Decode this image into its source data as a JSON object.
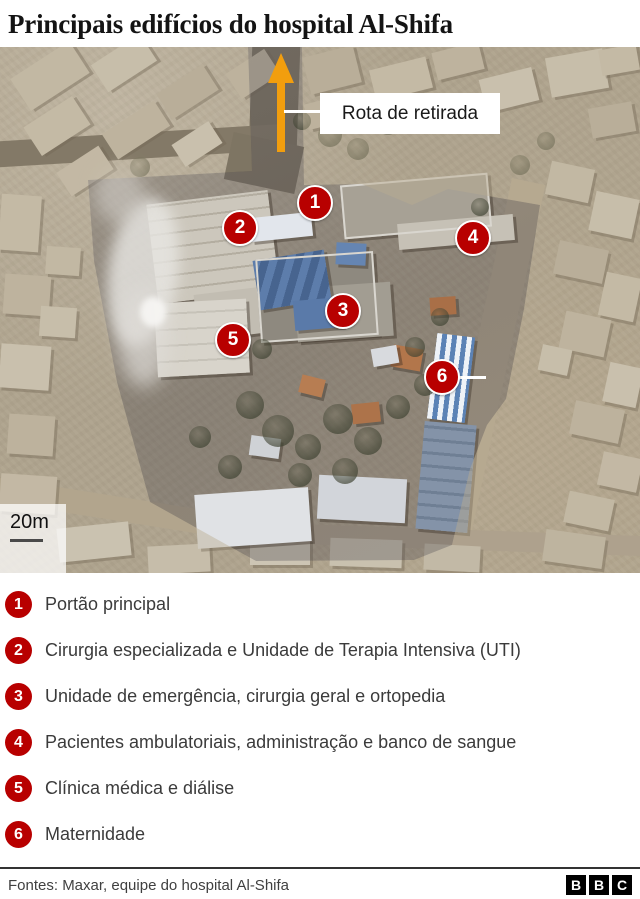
{
  "title": "Principais edifícios do hospital Al-Shifa",
  "map": {
    "route_label": "Rota de retirada",
    "scale_label": "20m",
    "markers": [
      {
        "number": "1",
        "x": 315,
        "y": 156
      },
      {
        "number": "2",
        "x": 240,
        "y": 181
      },
      {
        "number": "3",
        "x": 343,
        "y": 264
      },
      {
        "number": "4",
        "x": 473,
        "y": 191
      },
      {
        "number": "5",
        "x": 233,
        "y": 293
      },
      {
        "number": "6",
        "x": 442,
        "y": 330
      }
    ],
    "marker6_leader": {
      "x": 458,
      "y": 329,
      "length": 28
    }
  },
  "legend": {
    "items": [
      {
        "number": "1",
        "label": "Portão principal"
      },
      {
        "number": "2",
        "label": "Cirurgia especializada e Unidade de Terapia Intensiva (UTI)"
      },
      {
        "number": "3",
        "label": "Unidade de emergência, cirurgia geral e ortopedia"
      },
      {
        "number": "4",
        "label": "Pacientes ambulatoriais, administração e banco de sangue"
      },
      {
        "number": "5",
        "label": "Clínica médica e diálise"
      },
      {
        "number": "6",
        "label": "Maternidade"
      }
    ]
  },
  "footer": {
    "source": "Fontes: Maxar, equipe do hospital Al-Shifa",
    "logo_letters": [
      "B",
      "B",
      "C"
    ]
  },
  "colors": {
    "marker_red": "#b80000",
    "arrow_orange": "#f29e0e"
  }
}
